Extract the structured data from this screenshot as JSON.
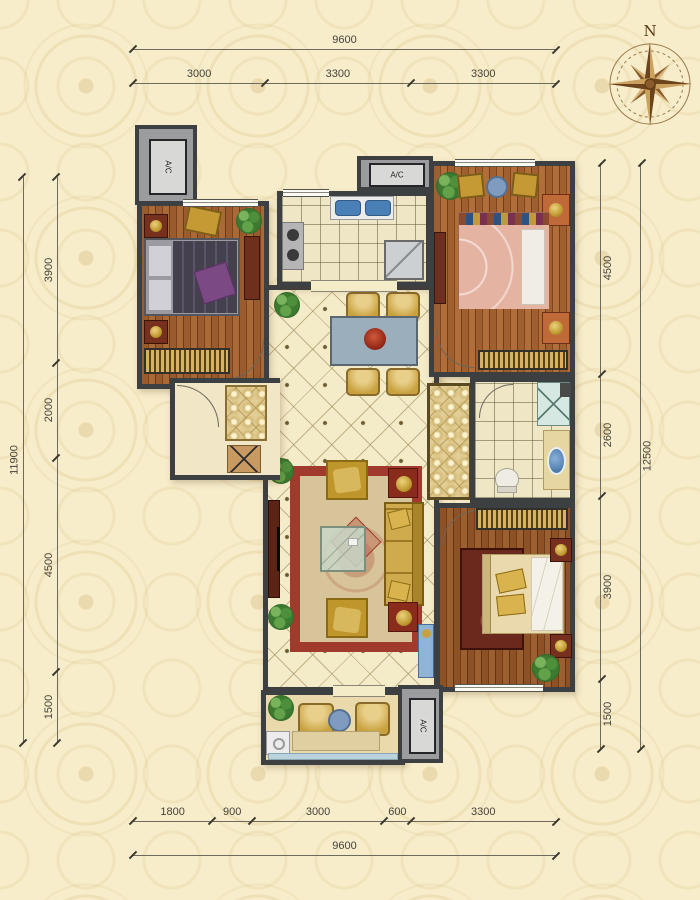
{
  "compass": {
    "north_label": "N"
  },
  "dimensions": {
    "top": {
      "overall": "9600",
      "segments": [
        "3000",
        "3300",
        "3300"
      ]
    },
    "bottom": {
      "overall": "9600",
      "segments": [
        "1800",
        "900",
        "3000",
        "600",
        "3300"
      ]
    },
    "left": {
      "overall": "11900",
      "segments": [
        "3900",
        "2000",
        "4500",
        "1500"
      ]
    },
    "right": {
      "overall": "12500",
      "segments": [
        "4500",
        "2600",
        "3900",
        "1500"
      ]
    }
  },
  "labels": {
    "ac": "A/C"
  },
  "colors": {
    "background": "#f7edcb",
    "pattern": "#d0b068",
    "wall": "#3d4043",
    "wood": "#8a4f28",
    "tile": "#f4ebc9",
    "accent_gold": "#c9a23f",
    "rug_red": "#a03a2c",
    "water_blue": "#7f9cc0",
    "plant_green": "#3e7a35",
    "dimension_text": "#46423a"
  }
}
